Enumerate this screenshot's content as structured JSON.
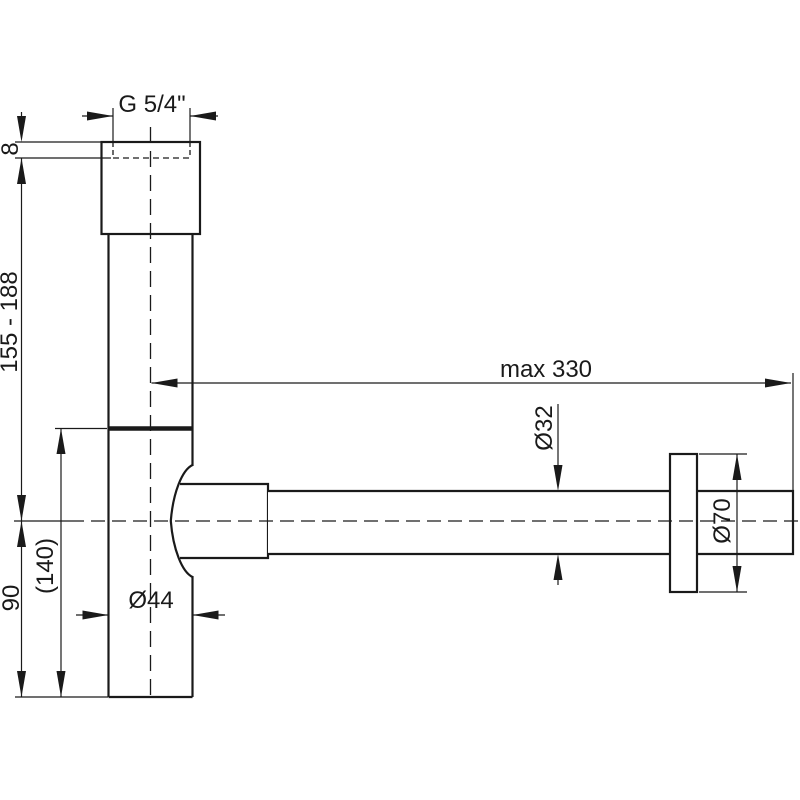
{
  "meta": {
    "background_color": "#ffffff",
    "line_color": "#1a1a1a",
    "drawing_type": "technical dimensional drawing of a design bottle trap (siphon), side view"
  },
  "labels": {
    "thread_size": "G 5/4\"",
    "thread_depth": "8",
    "inlet_height_range": "155 - 188",
    "body_height": "90",
    "overall_height": "(140)",
    "body_diameter": "Ø44",
    "max_horizontal_reach": "max 330",
    "outlet_pipe_diameter": "Ø32",
    "wall_flange_diameter": "Ø70"
  }
}
